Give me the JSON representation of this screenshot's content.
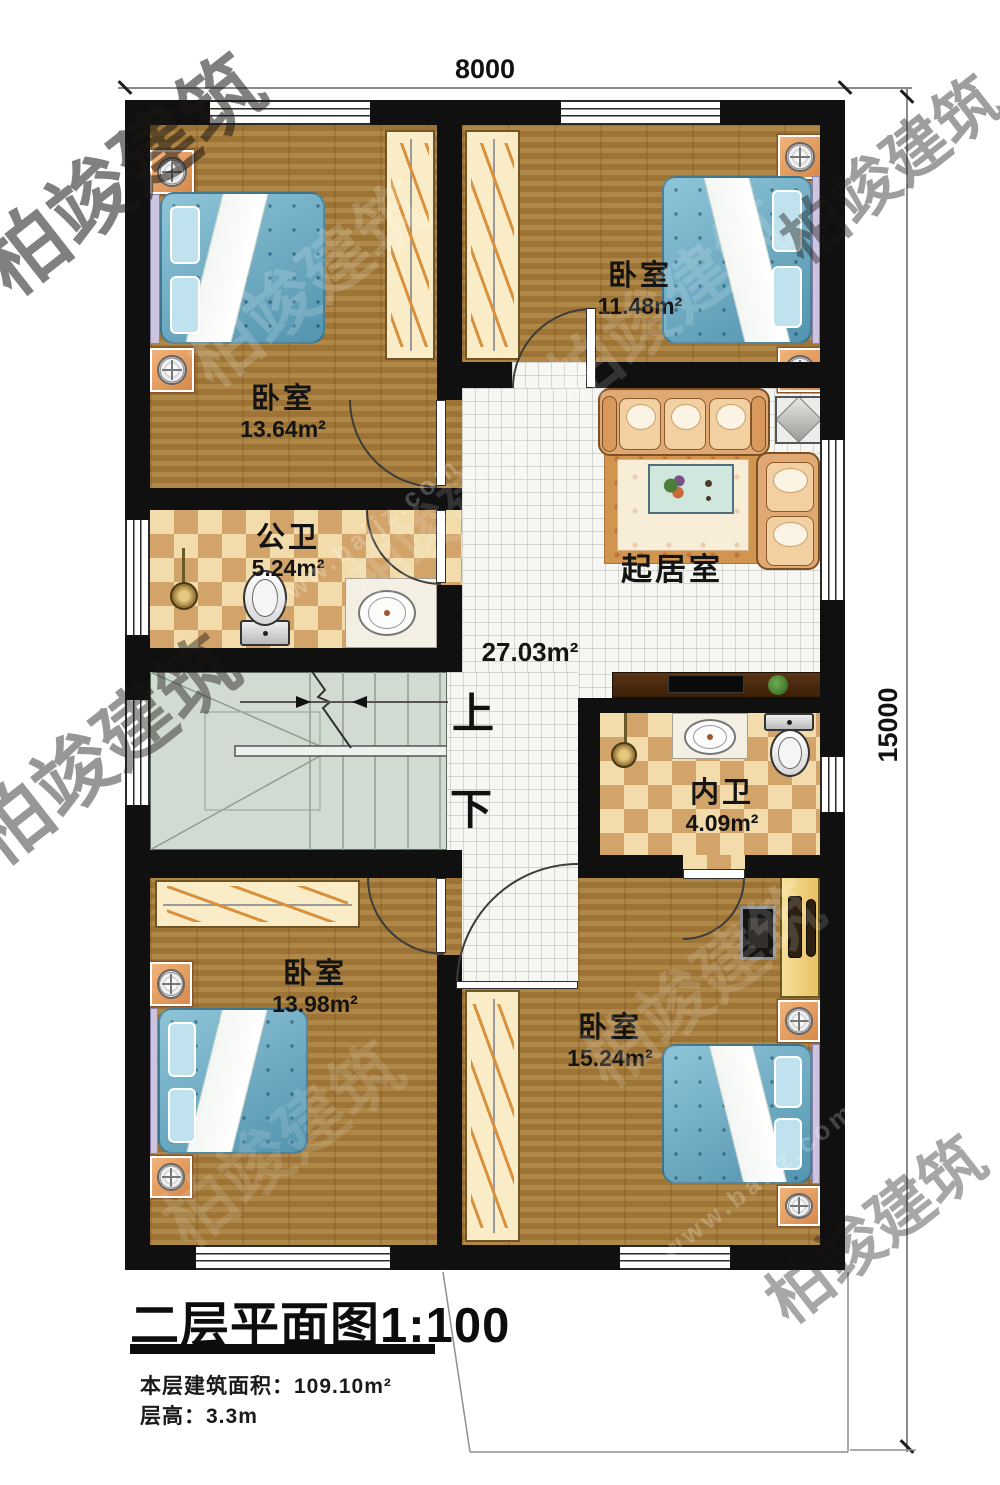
{
  "dimensions": {
    "width_label": "8000",
    "height_label": "15000"
  },
  "rooms": {
    "bedroom_tl": {
      "name": "卧室",
      "area": "13.64m²"
    },
    "bedroom_tr": {
      "name": "卧室",
      "area": "11.48m²"
    },
    "public_bath": {
      "name": "公卫",
      "area": "5.24m²"
    },
    "living": {
      "name": "起居室",
      "area": "27.03m²"
    },
    "inner_bath": {
      "name": "内卫",
      "area": "4.09m²"
    },
    "bedroom_bl": {
      "name": "卧室",
      "area": "13.98m²"
    },
    "bedroom_br": {
      "name": "卧室",
      "area": "15.24m²"
    }
  },
  "stairs": {
    "up_label": "上",
    "down_label": "下"
  },
  "title_block": {
    "title": "二层平面图",
    "scale": "1:100",
    "area_note": "本层建筑面积：109.10m²",
    "height_note": "层高：3.3m"
  },
  "watermark": {
    "logo_text": "柏竣建筑",
    "url_text": "www.baijz.com"
  }
}
